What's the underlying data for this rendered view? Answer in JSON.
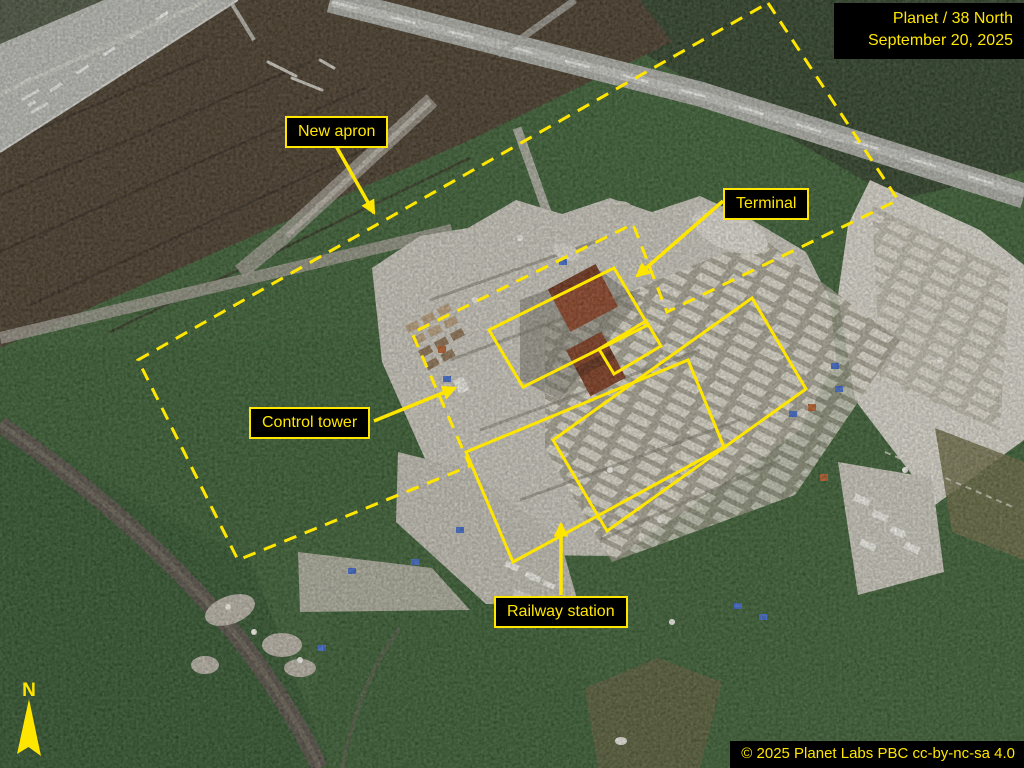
{
  "header": {
    "source": "Planet / 38 North",
    "date": "September 20, 2025"
  },
  "footer": {
    "license": "© 2025 Planet Labs PBC cc-by-nc-sa 4.0"
  },
  "labels": {
    "new_apron": "New apron",
    "terminal": "Terminal",
    "control_tower": "Control tower",
    "railway_station": "Railway station"
  },
  "compass": {
    "north": "N"
  },
  "annotation_shapes": {
    "dashed_boundary": "construction area perimeter (yellow dashed polygon)",
    "solid_boxes": [
      "terminal-box",
      "terminal-annex-box",
      "foundations-box",
      "railway-station-box"
    ]
  },
  "colors": {
    "annotation_yellow": "#ffe600",
    "label_background": "#000000"
  }
}
